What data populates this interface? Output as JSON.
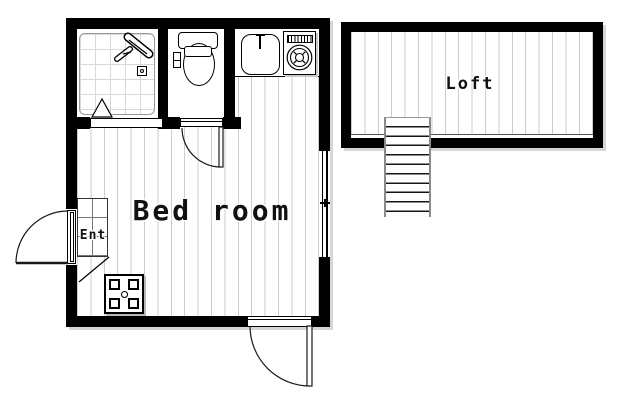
{
  "title": "One-room floor plan with loft",
  "rooms": {
    "bedroom": {
      "label": "Bed room"
    },
    "loft": {
      "label": "Loft"
    },
    "entrance": {
      "label": "Ent"
    }
  },
  "fixtures": {
    "bathroom": [
      "shower-unit",
      "shower-faucet-box",
      "folding-door-triangle"
    ],
    "toilet_room": [
      "toilet"
    ],
    "kitchen_counter": [
      "sink",
      "washing-machine"
    ],
    "bedroom": [
      "low-table"
    ],
    "loft": [
      "staircase"
    ],
    "openings": [
      "entrance-door",
      "bedroom-door",
      "toilet-door",
      "sliding-window"
    ]
  },
  "colors": {
    "wall": "#000000",
    "floor_line": "#cdcdcd",
    "tile_line": "#d8d8d8",
    "stair_rail": "#8a8a8a",
    "shadow": "#d6d6d6",
    "text": "#111111",
    "background": "#ffffff"
  }
}
